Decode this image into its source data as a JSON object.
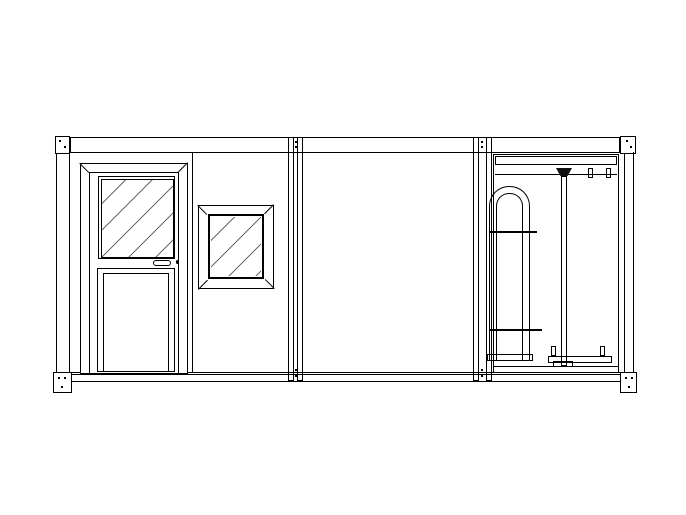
{
  "meta": {
    "title": "Elevation drawing: modular container cabin with personnel door, window and full-height turnstile",
    "background": "#ffffff",
    "line_color": "#000000",
    "watermark_color": "#d2d2d2"
  },
  "modules": [
    {
      "id": "left",
      "label": "cabin module with glazed door and window"
    },
    {
      "id": "middle",
      "label": "cabin module with vertical panel wall"
    },
    {
      "id": "right",
      "label": "full-height turnstile module"
    }
  ],
  "repeats": {
    "siding_above_door": 6,
    "siding_above_window": 5,
    "siding_below_window": 5,
    "middle_siding": 10,
    "door_vent_slats": 9,
    "vent_ticks": 4
  },
  "turnstile": {
    "long_arm_start_x": 500,
    "short_arm_start_x": 566,
    "arm_end_x": 617,
    "pivot_x": 589,
    "clip_x": 613,
    "arms": [
      {
        "y": 180,
        "kind": "long"
      },
      {
        "y": 200,
        "kind": "short"
      },
      {
        "y": 221,
        "kind": "long"
      },
      {
        "y": 241,
        "kind": "short"
      },
      {
        "y": 262,
        "kind": "long"
      },
      {
        "y": 282,
        "kind": "short"
      },
      {
        "y": 303,
        "kind": "long"
      },
      {
        "y": 323,
        "kind": "short"
      },
      {
        "y": 344,
        "kind": "long"
      }
    ],
    "vertical_bar_x": [
      500,
      507,
      514,
      521
    ],
    "bar_clips": [
      {
        "x": 500,
        "y": 219
      },
      {
        "x": 507,
        "y": 219
      },
      {
        "x": 514,
        "y": 219
      },
      {
        "x": 500,
        "y": 249
      },
      {
        "x": 500,
        "y": 279
      },
      {
        "x": 507,
        "y": 279
      },
      {
        "x": 500,
        "y": 309
      },
      {
        "x": 500,
        "y": 339
      }
    ]
  },
  "base": {
    "feet_x": [
      163,
      289,
      519
    ]
  },
  "watermark": {
    "blobs": [
      {
        "x": 243,
        "y": 320
      },
      {
        "x": 290,
        "y": 289
      },
      {
        "x": 337,
        "y": 257
      },
      {
        "x": 384,
        "y": 224
      },
      {
        "x": 430,
        "y": 192
      }
    ]
  }
}
